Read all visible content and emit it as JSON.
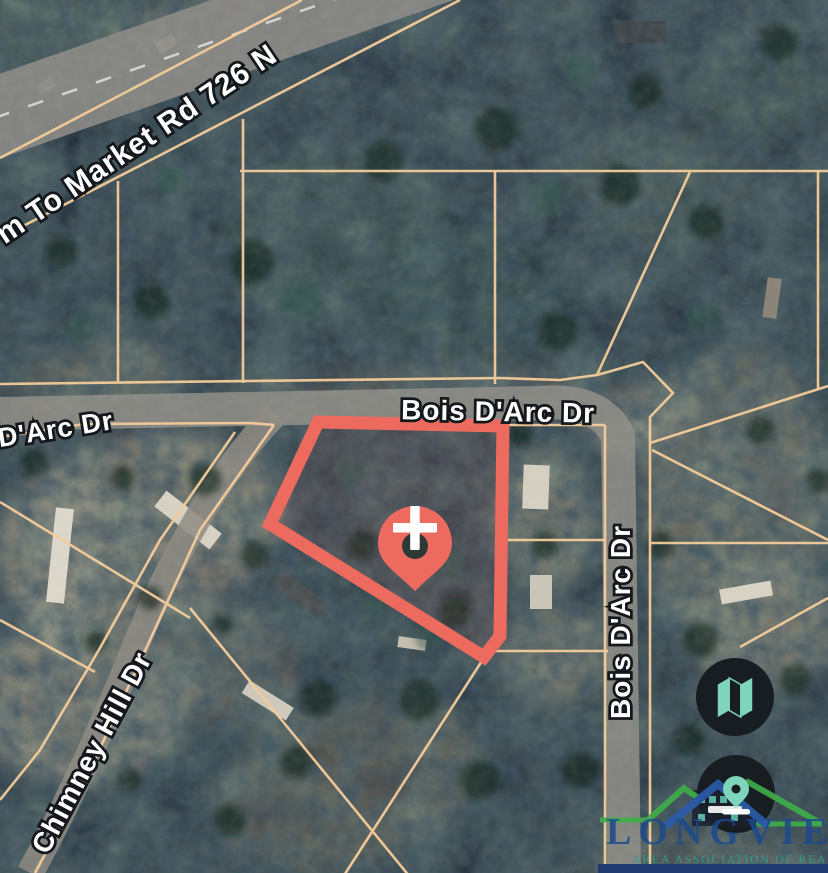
{
  "map": {
    "type": "satellite-parcel-map",
    "road_labels": [
      {
        "id": "farm-to-market-rd",
        "text": "m To Market Rd 726 N"
      },
      {
        "id": "darc-dr-west",
        "text": "D'Arc Dr"
      },
      {
        "id": "bois-darc-dr-horizontal",
        "text": "Bois D'Arc Dr"
      },
      {
        "id": "bois-darc-dr-vertical",
        "text": "Bois D'Arc Dr"
      },
      {
        "id": "chimney-hill-dr",
        "text": "Chimney Hill Dr"
      }
    ],
    "highlighted_parcel": {
      "outline_color": "#ed6a5f",
      "marker": "location-pin-with-plus-crosshair",
      "pin_color": "#ed6a5f",
      "crosshair_color": "#ffffff"
    },
    "colors": {
      "parcel_line": "#f4cc9a",
      "forest_dark": "#1e2835",
      "open_ground": "#867c6e",
      "road_gray": "#908e88",
      "button_background": "#171d21",
      "button_icon_teal": "#7fd4bc",
      "watermark_navy": "#1d4a8c",
      "watermark_teal": "#2f9e8f",
      "watermark_green": "#3fae49",
      "watermark_blue": "#2b5cab",
      "bottom_bar_navy": "#1e3a6e"
    },
    "controls": [
      {
        "id": "map-layers-button",
        "icon": "folded-map-icon"
      },
      {
        "id": "drop-pin-button",
        "icon": "location-pin-icon"
      }
    ],
    "watermark": {
      "title": "LONGVIEW",
      "subtitle": "AREA ASSOCIATION OF REALTORS"
    }
  }
}
